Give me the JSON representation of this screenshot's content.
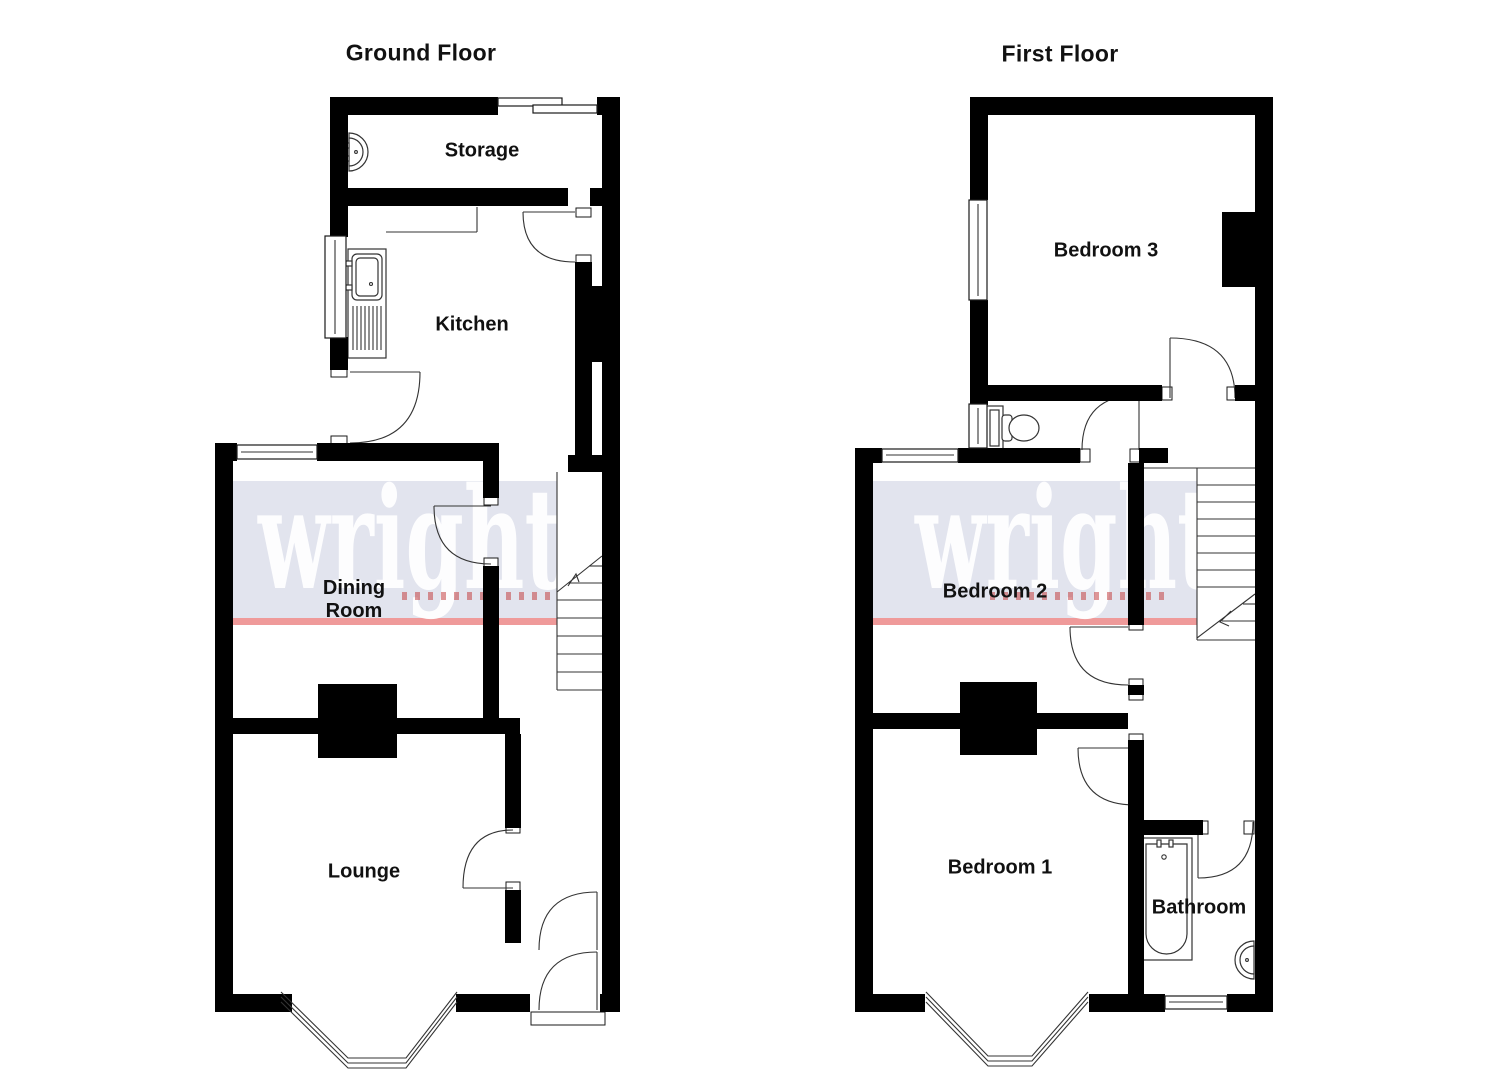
{
  "ground_floor": {
    "title": "Ground Floor",
    "rooms": {
      "storage": "Storage",
      "kitchen": "Kitchen",
      "dining_line1": "Dining",
      "dining_line2": "Room",
      "lounge": "Lounge"
    }
  },
  "first_floor": {
    "title": "First Floor",
    "rooms": {
      "bedroom3": "Bedroom 3",
      "bedroom2": "Bedroom 2",
      "bedroom1": "Bedroom 1",
      "bathroom": "Bathroom"
    }
  },
  "watermark": {
    "text": "wright",
    "band_color": "#e2e4ee",
    "text_color": "#ffffff",
    "accent_line_color": "#ef9a9a",
    "subtext_color": "#c03030"
  },
  "canvas": {
    "background": "#ffffff",
    "wall_color": "#000000",
    "line_color": "#1a1a1a"
  }
}
